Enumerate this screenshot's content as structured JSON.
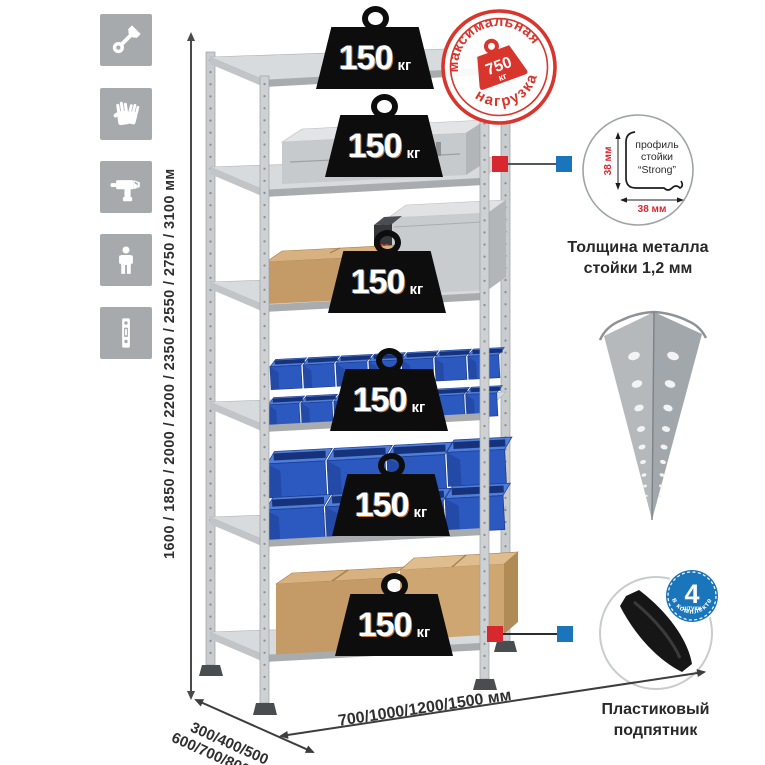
{
  "colors": {
    "accent_red": "#d7282f",
    "accent_blue": "#1b75bb",
    "stamp_red": "#d8352d",
    "bin_blue": "#2b59c0",
    "box_tan": "#c49a66",
    "metal_gray": "#c9ccce",
    "icon_tile_gray": "#a6aaad",
    "weight_black": "#0d0d0d"
  },
  "sidebar_icons": [
    {
      "name": "wrench-icon"
    },
    {
      "name": "gloves-icon"
    },
    {
      "name": "drill-icon"
    },
    {
      "name": "person-icon"
    },
    {
      "name": "upright-post-icon"
    }
  ],
  "dimensions": {
    "height": "1600 / 1850 / 2000 / 2200 / 2350 / 2550 / 2750 / 3100 мм",
    "depth_line1": "300/400/500",
    "depth_line2": "600/700/800 мм",
    "width": "700/1000/1200/1500 мм"
  },
  "weights": [
    {
      "value": "150",
      "unit": "кг"
    },
    {
      "value": "150",
      "unit": "кг"
    },
    {
      "value": "150",
      "unit": "кг"
    },
    {
      "value": "150",
      "unit": "кг"
    },
    {
      "value": "150",
      "unit": "кг"
    },
    {
      "value": "150",
      "unit": "кг"
    }
  ],
  "stamp": {
    "arc_top": "максимальная",
    "arc_bottom": "нагрузка",
    "value": "750",
    "unit": "кг"
  },
  "profile": {
    "label_line1": "профиль",
    "label_line2": "стойки",
    "label_line3": "“Strong”",
    "dim_side": "38 мм",
    "dim_bottom": "38 мм",
    "caption_line1": "Толщина металла",
    "caption_line2": "стойки 1,2 мм"
  },
  "foot": {
    "badge_value": "4",
    "badge_sub": "штуки",
    "badge_arc": "в комплекте",
    "caption_line1": "Пластиковый",
    "caption_line2": "подпятник"
  }
}
